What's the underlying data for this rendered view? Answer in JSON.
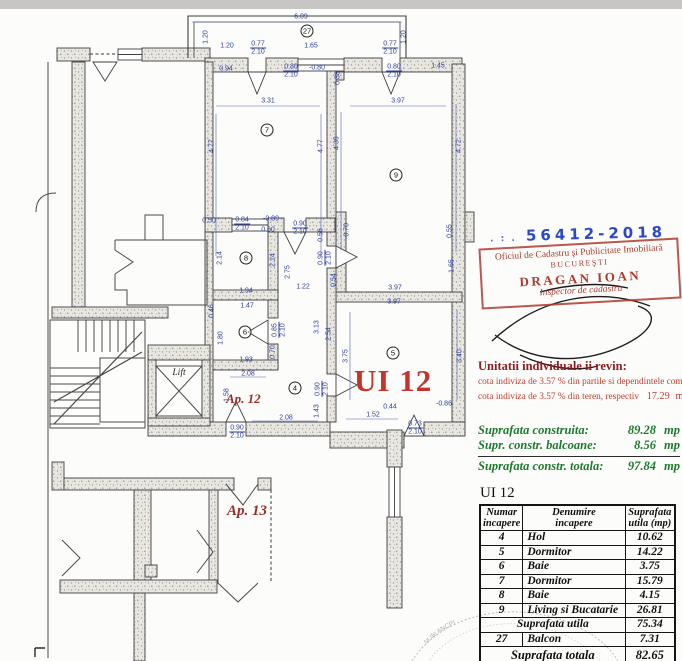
{
  "plan": {
    "unit_title": "UI 12",
    "apartment_label": "Ap. 12",
    "neighbor_apartment_label": "Ap. 13",
    "lift_label": "Lift",
    "rooms": [
      {
        "n": "27",
        "x": 307,
        "y": 31
      },
      {
        "n": "7",
        "x": 267,
        "y": 130
      },
      {
        "n": "9",
        "x": 396,
        "y": 175
      },
      {
        "n": "8",
        "x": 246,
        "y": 258
      },
      {
        "n": "6",
        "x": 245,
        "y": 332
      },
      {
        "n": "4",
        "x": 295,
        "y": 388
      },
      {
        "n": "5",
        "x": 393,
        "y": 353
      }
    ],
    "dims": [
      {
        "t": "6.09",
        "x": 301,
        "y": 17
      },
      {
        "t": "1.20",
        "x": 206,
        "y": 37,
        "r": -90
      },
      {
        "t": "1.20",
        "x": 404,
        "y": 37,
        "r": -90
      },
      {
        "t": "1.20",
        "x": 227,
        "y": 46
      },
      {
        "t": "0.77",
        "t2": "2.10",
        "x": 258,
        "y": 48
      },
      {
        "t": "1.65",
        "x": 311,
        "y": 46
      },
      {
        "t": "0.77",
        "t2": "2.10",
        "x": 390,
        "y": 48
      },
      {
        "t": "0.94",
        "x": 226,
        "y": 69
      },
      {
        "t": "0.80",
        "t2": "2.10",
        "x": 291,
        "y": 71
      },
      {
        "t": "-0.80",
        "x": 317,
        "y": 68
      },
      {
        "t": "0.38",
        "x": 338,
        "y": 78,
        "r": -90
      },
      {
        "t": "0.80",
        "t2": "2.10",
        "x": 394,
        "y": 71
      },
      {
        "t": "1.45",
        "x": 438,
        "y": 66
      },
      {
        "t": "3.31",
        "x": 268,
        "y": 101
      },
      {
        "t": "3.97",
        "x": 398,
        "y": 101
      },
      {
        "t": "4.77",
        "x": 212,
        "y": 146,
        "r": -90
      },
      {
        "t": "4.77",
        "x": 321,
        "y": 146,
        "r": -90
      },
      {
        "t": "4.39",
        "x": 337,
        "y": 143,
        "r": -90
      },
      {
        "t": "4.72",
        "x": 459,
        "y": 146,
        "r": -90
      },
      {
        "t": "0.50",
        "x": 209,
        "y": 221
      },
      {
        "t": "0.84",
        "t2": "2.10",
        "x": 242,
        "y": 224
      },
      {
        "t": "-0.89",
        "x": 271,
        "y": 219
      },
      {
        "t": "0.60",
        "x": 268,
        "y": 230
      },
      {
        "t": "0.90",
        "t2": "2.10",
        "x": 300,
        "y": 228
      },
      {
        "t": "0.56",
        "x": 321,
        "y": 235,
        "r": -90
      },
      {
        "t": "-0.70",
        "x": 347,
        "y": 231,
        "r": -90
      },
      {
        "t": "0.55",
        "x": 450,
        "y": 231,
        "r": -90
      },
      {
        "t": "0.90",
        "t2": "2.10",
        "x": 325,
        "y": 258,
        "r": -90
      },
      {
        "t": "2.14",
        "x": 220,
        "y": 258,
        "r": -90
      },
      {
        "t": "2.14",
        "x": 273,
        "y": 260,
        "r": -90
      },
      {
        "t": "2.75",
        "x": 288,
        "y": 272,
        "r": -90
      },
      {
        "t": "0.54",
        "x": 334,
        "y": 280,
        "r": -90
      },
      {
        "t": "1.65",
        "x": 452,
        "y": 266,
        "r": -90
      },
      {
        "t": "1.94",
        "x": 246,
        "y": 291
      },
      {
        "t": "1.22",
        "x": 303,
        "y": 287
      },
      {
        "t": "3.97",
        "x": 395,
        "y": 288
      },
      {
        "t": "3.97",
        "x": 394,
        "y": 302
      },
      {
        "t": "1.47",
        "x": 247,
        "y": 306
      },
      {
        "t": "0.46",
        "x": 212,
        "y": 311,
        "r": -90
      },
      {
        "t": "1.80",
        "x": 221,
        "y": 338,
        "r": -90
      },
      {
        "t": "0.85",
        "t2": "2.10",
        "x": 279,
        "y": 330,
        "r": -90
      },
      {
        "t": "3.13",
        "x": 317,
        "y": 327,
        "r": -90
      },
      {
        "t": "2.54",
        "x": 329,
        "y": 334,
        "r": -90
      },
      {
        "t": "0.70",
        "x": 273,
        "y": 352,
        "r": -90
      },
      {
        "t": "3.75",
        "x": 346,
        "y": 356,
        "r": -90
      },
      {
        "t": "3.40",
        "x": 460,
        "y": 356,
        "r": -90
      },
      {
        "t": "1.93",
        "x": 246,
        "y": 360
      },
      {
        "t": "2.08",
        "x": 248,
        "y": 374
      },
      {
        "t": "1.58",
        "x": 227,
        "y": 395,
        "r": -90
      },
      {
        "t": "0.90",
        "t2": "2.10",
        "x": 322,
        "y": 389,
        "r": -90
      },
      {
        "t": "1.43",
        "x": 317,
        "y": 411,
        "r": -90
      },
      {
        "t": "2.08",
        "x": 286,
        "y": 418
      },
      {
        "t": "1.52",
        "x": 373,
        "y": 415
      },
      {
        "t": "0.44",
        "x": 390,
        "y": 407
      },
      {
        "t": "-0.86",
        "x": 444,
        "y": 404
      },
      {
        "t": "0.73",
        "t2": "2.10",
        "x": 415,
        "y": 428
      },
      {
        "t": "0.90",
        "t2": "2.10",
        "x": 237,
        "y": 432
      }
    ]
  },
  "registration": {
    "number_prefix": ". : .",
    "number": "56412-2018",
    "office_line1": "Oficiul de Cadastru şi Publicitate Imobiliară",
    "office_line2": "BUCUREŞTI",
    "inspector_name": "DRAGAN IOAN",
    "inspector_title": "Inspector de cadastru"
  },
  "quota_note": {
    "heading": "Unitatii individuale ii revin:",
    "line1": "cota indiviza de  3.57 % din partile si dependintele comune",
    "line2": "cota indiviza de  3.57 % din teren, respectiv",
    "line2_value": "17.29",
    "line2_unit": "mp"
  },
  "areas": {
    "rows": [
      {
        "label": "Suprafata construita:",
        "value": "89.28",
        "unit": "mp"
      },
      {
        "label": "Supr. constr. balcoane:",
        "value": "8.56",
        "unit": "mp"
      }
    ],
    "total": {
      "label": "Suprafata constr. totala:",
      "value": "97.84",
      "unit": "mp"
    }
  },
  "table": {
    "title": "UI 12",
    "headers": [
      {
        "l1": "Numar",
        "l2": "incapere"
      },
      {
        "l1": "Denumire",
        "l2": "incapere"
      },
      {
        "l1": "Suprafata",
        "l2": "utila (mp)"
      }
    ],
    "rows": [
      {
        "num": "4",
        "name": "Hol",
        "area": "10.62"
      },
      {
        "num": "5",
        "name": "Dormitor",
        "area": "14.22"
      },
      {
        "num": "6",
        "name": "Baie",
        "area": "3.75"
      },
      {
        "num": "7",
        "name": "Dormitor",
        "area": "15.79"
      },
      {
        "num": "8",
        "name": "Baie",
        "area": "4.15"
      },
      {
        "num": "9",
        "name": "Living si Bucatarie",
        "area": "26.81"
      }
    ],
    "subtotal": {
      "label": "Suprafata utila",
      "value": "75.34"
    },
    "extra_row": {
      "num": "27",
      "name": "Balcon",
      "value": "7.31"
    },
    "total": {
      "label": "Suprafata totala",
      "value": "82.65"
    }
  },
  "corner_stamp": {
    "arc_text": "ta de ANCPI"
  },
  "colors": {
    "dimension_text": "#2c3e9e",
    "unit_red": "#c5342c",
    "stamp_red": "#b03a2e",
    "stamp_number_blue": "#2947c8",
    "note_green": "#1d7a2d",
    "note_red": "#c23b2b"
  }
}
